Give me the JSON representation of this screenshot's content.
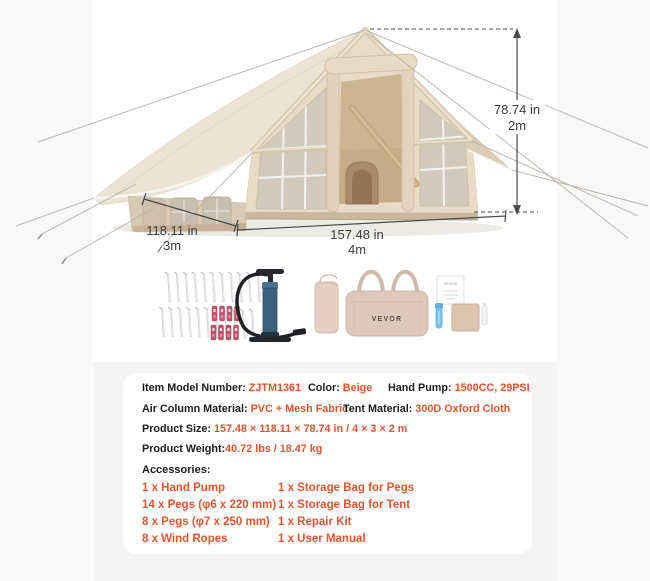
{
  "colors": {
    "accent": "#e8542e",
    "label_text": "#1d1d1f",
    "dimension_text": "#3d3d3f",
    "panel_bg": "#f4f4f5",
    "card_bg": "#ffffff",
    "tent_beige": "#e8dcc9"
  },
  "tent_dimensions": {
    "height": {
      "imperial": "78.74 in",
      "metric": "2m"
    },
    "depth": {
      "imperial": "118.11 in",
      "metric": "3m"
    },
    "width": {
      "imperial": "157.48 in",
      "metric": "4m"
    }
  },
  "specs": {
    "row1": [
      {
        "label": "Item Model Number: ",
        "value": "ZJTM1361"
      },
      {
        "label": "Color: ",
        "value": "Beige"
      },
      {
        "label": "Hand Pump: ",
        "value": "1500CC, 29PSI"
      }
    ],
    "row2": [
      {
        "label": "Air Column Material: ",
        "value": "PVC + Mesh Fabric"
      },
      {
        "label": "Tent Material: ",
        "value": "300D Oxford Cloth"
      }
    ],
    "row3": [
      {
        "label": "Product Size: ",
        "value": "157.48 × 118.11 × 78.74 in / 4 × 3 × 2 m"
      }
    ],
    "row4": [
      {
        "label": "Product Weight:",
        "value": "40.72 lbs / 18.47 kg"
      }
    ]
  },
  "accessories": {
    "heading": "Accessories:",
    "left": [
      "1 x Hand Pump",
      "14 x Pegs (φ6 x 220 mm)",
      "8 x Pegs (φ7 x 250 mm)",
      "8 x Wind Ropes"
    ],
    "right": [
      "1 x Storage Bag for Pegs",
      "1 x Storage Bag for Tent",
      "1 x Repair Kit",
      "1 x User Manual"
    ]
  },
  "accessories_visual": {
    "bag_label": "VEVOR",
    "manual_label": "VEVOR"
  }
}
